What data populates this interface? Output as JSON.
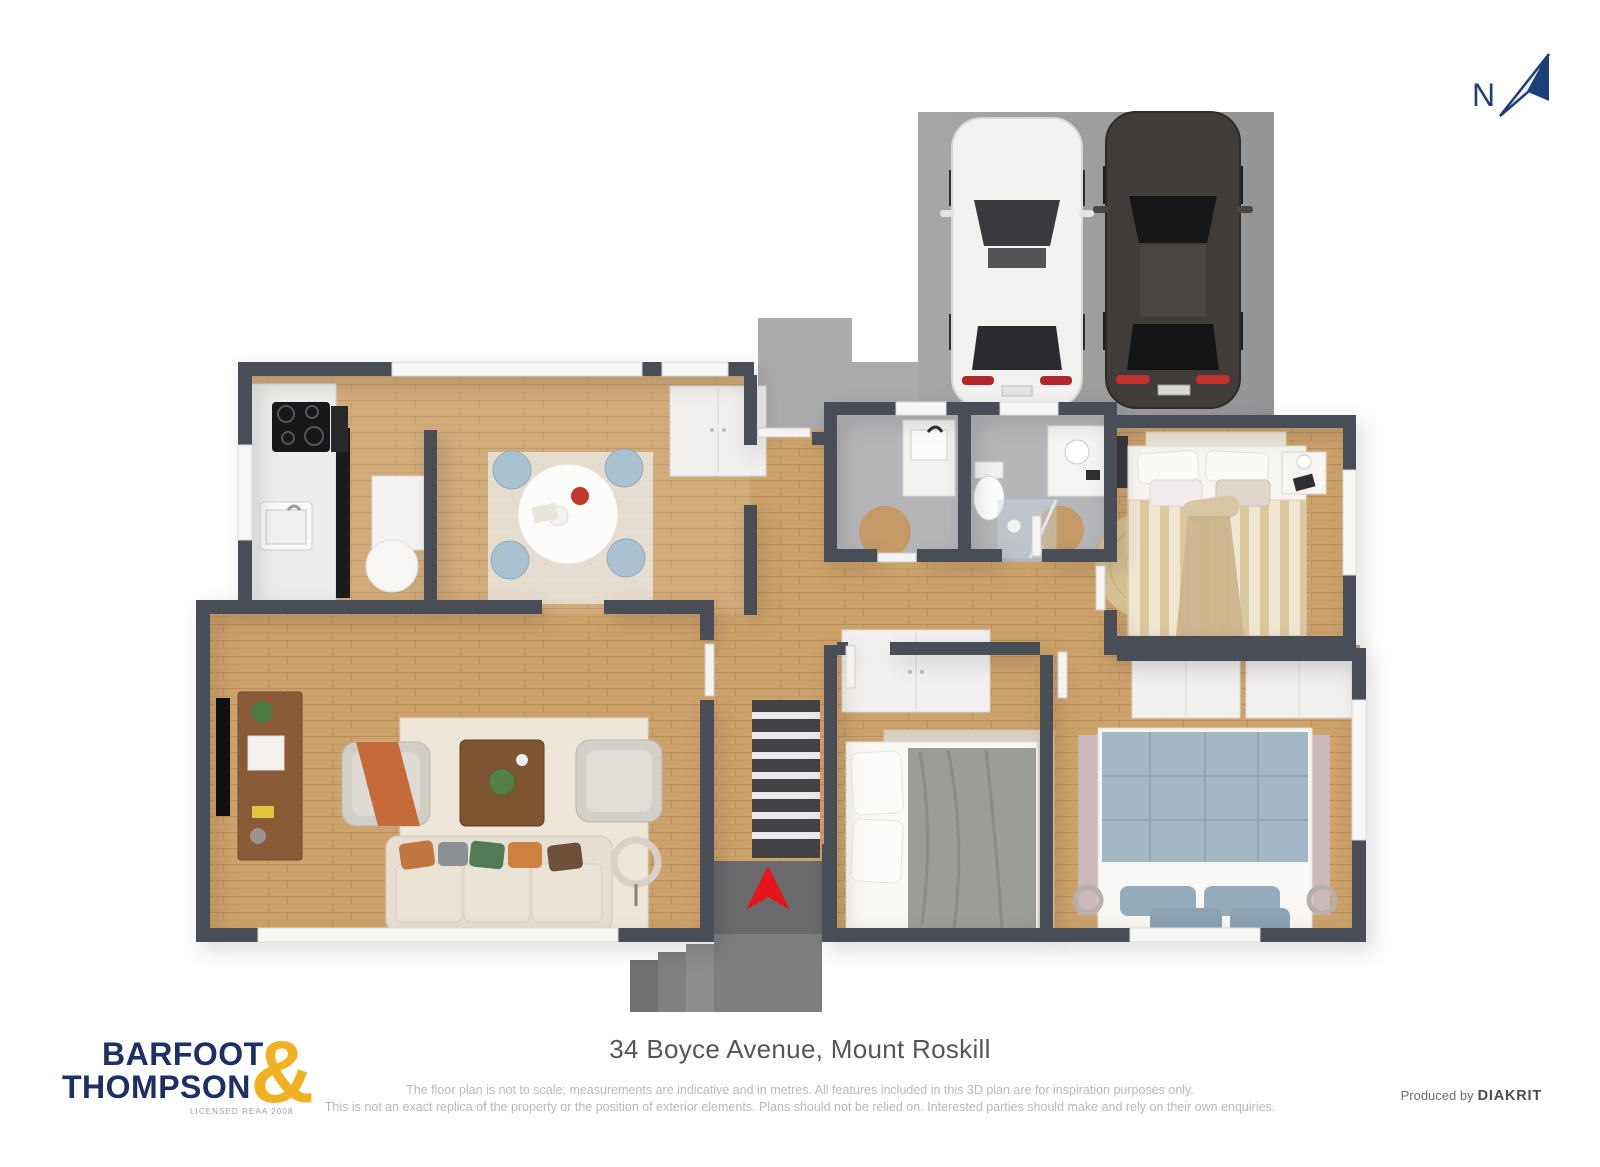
{
  "page": {
    "background_color": "#ffffff"
  },
  "north_indicator": {
    "label": "N",
    "color": "#1d3f7a"
  },
  "footer": {
    "title": "34 Boyce Avenue, Mount Roskill",
    "disclaimer_line1": "The floor plan is not to scale; measurements are indicative and in metres. All features included in this 3D plan are for inspiration purposes only.",
    "disclaimer_line2": "This is not an exact replica of the property or the position of exterior elements. Plans should not be relied on. Interested parties should make and rely on their own enquiries.",
    "credit_prefix": "Produced by",
    "credit_brand": "DIAKRIT"
  },
  "logo": {
    "line1": "BARFOOT",
    "line2": "THOMPSON",
    "ampersand": "&",
    "tagline": "LICENSED REAA 2008",
    "navy_color": "#1e2f63",
    "gold_color": "#f2b120"
  },
  "floorplan": {
    "type": "3d_top_down_floor_plan",
    "rooms": [
      "kitchen",
      "dining-room",
      "living-room",
      "front-hall",
      "hallway",
      "laundry",
      "bathroom",
      "bedroom-1",
      "bedroom-2",
      "bedroom-3",
      "entry-porch"
    ],
    "exterior_features": [
      "driveway",
      "garden-path",
      "entry-steps"
    ],
    "vehicles": [
      "white-car",
      "dark-grey-car"
    ],
    "colors": {
      "exterior_wall": "#4a4d57",
      "wood_floor": "#cda26c",
      "tile_floor": "#b6b6b8",
      "driveway": "#9f9f9f",
      "entry_arrow": "#e8141c"
    }
  }
}
